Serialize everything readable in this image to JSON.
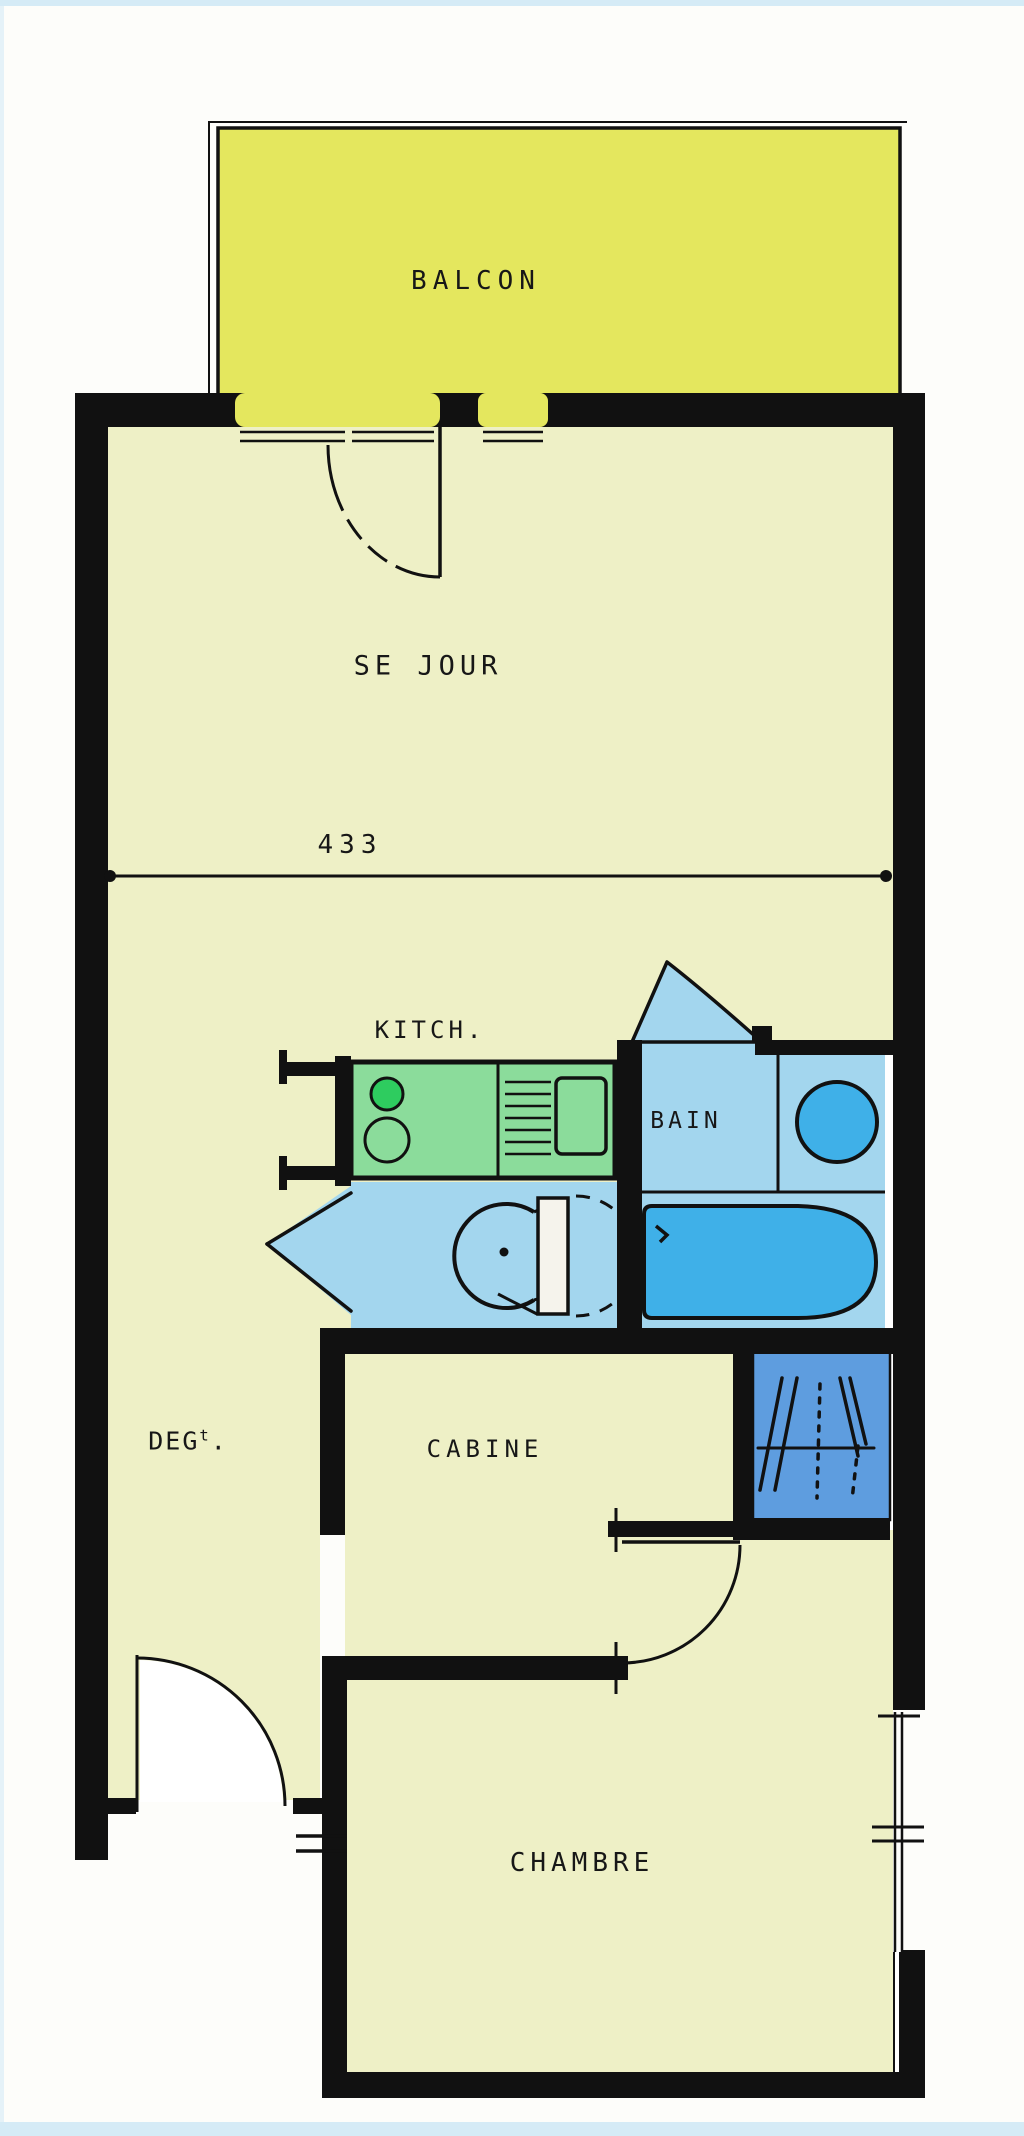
{
  "plan": {
    "title": "apartment-floor-plan",
    "labels": {
      "balcony": "BALCON",
      "living_room": "SE JOUR",
      "kitchen": "KITCH.",
      "bathroom": "BAIN",
      "hallway": "DEG",
      "hallway_sup": "t",
      "hallway_dot": ".",
      "cabin": "CABINE",
      "bedroom": "CHAMBRE"
    },
    "dimensions": {
      "living_room_width": "433"
    },
    "colors": {
      "balcony_fill": "#e4e75e",
      "floor_fill": "#eef0c6",
      "kitchen_counter": "#8bdc9b",
      "burner_green": "#2ecc5f",
      "wet_room_blue": "#a3d6ee",
      "fixture_blue": "#3fb0e8",
      "closet_blue": "#5e9ddf",
      "wall_black": "#111111",
      "scan_edge_blue": "#d5ebf6"
    }
  }
}
